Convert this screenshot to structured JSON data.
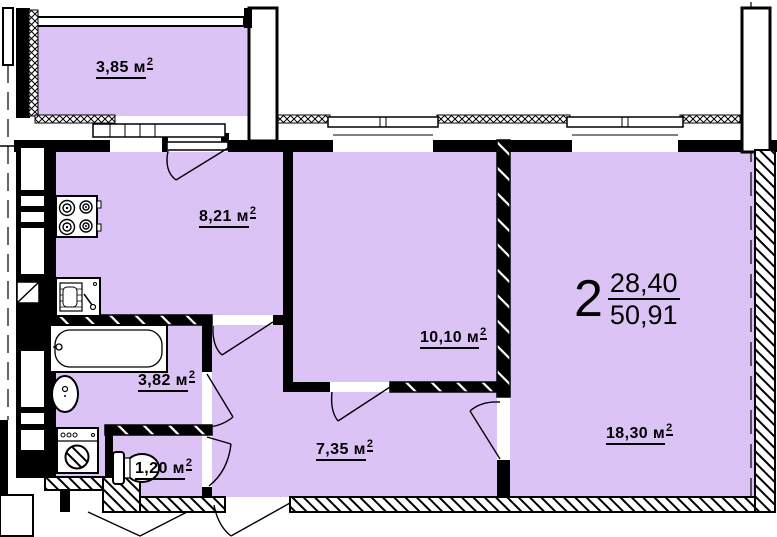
{
  "title": "apartment-floor-plan",
  "colors": {
    "room_fill": "#DBC4F5",
    "wall": "#000000",
    "background": "#FFFFFF"
  },
  "apartment": {
    "count": "2",
    "living": "28,40",
    "total": "50,91"
  },
  "rooms": {
    "balcony": {
      "label": "3,85 м",
      "sup": "2"
    },
    "kitchen": {
      "label": "8,21 м",
      "sup": "2"
    },
    "room10": {
      "label": "10,10 м",
      "sup": "2"
    },
    "room18": {
      "label": "18,30 м",
      "sup": "2"
    },
    "bathroom": {
      "label": "3,82 м",
      "sup": "2"
    },
    "wc": {
      "label": "1,20 м",
      "sup": "2"
    },
    "hallway": {
      "label": "7,35 м",
      "sup": "2"
    }
  },
  "fixtures": [
    "stove",
    "kitchen-sink",
    "bathtub",
    "wash-basin",
    "washing-machine",
    "toilet"
  ]
}
